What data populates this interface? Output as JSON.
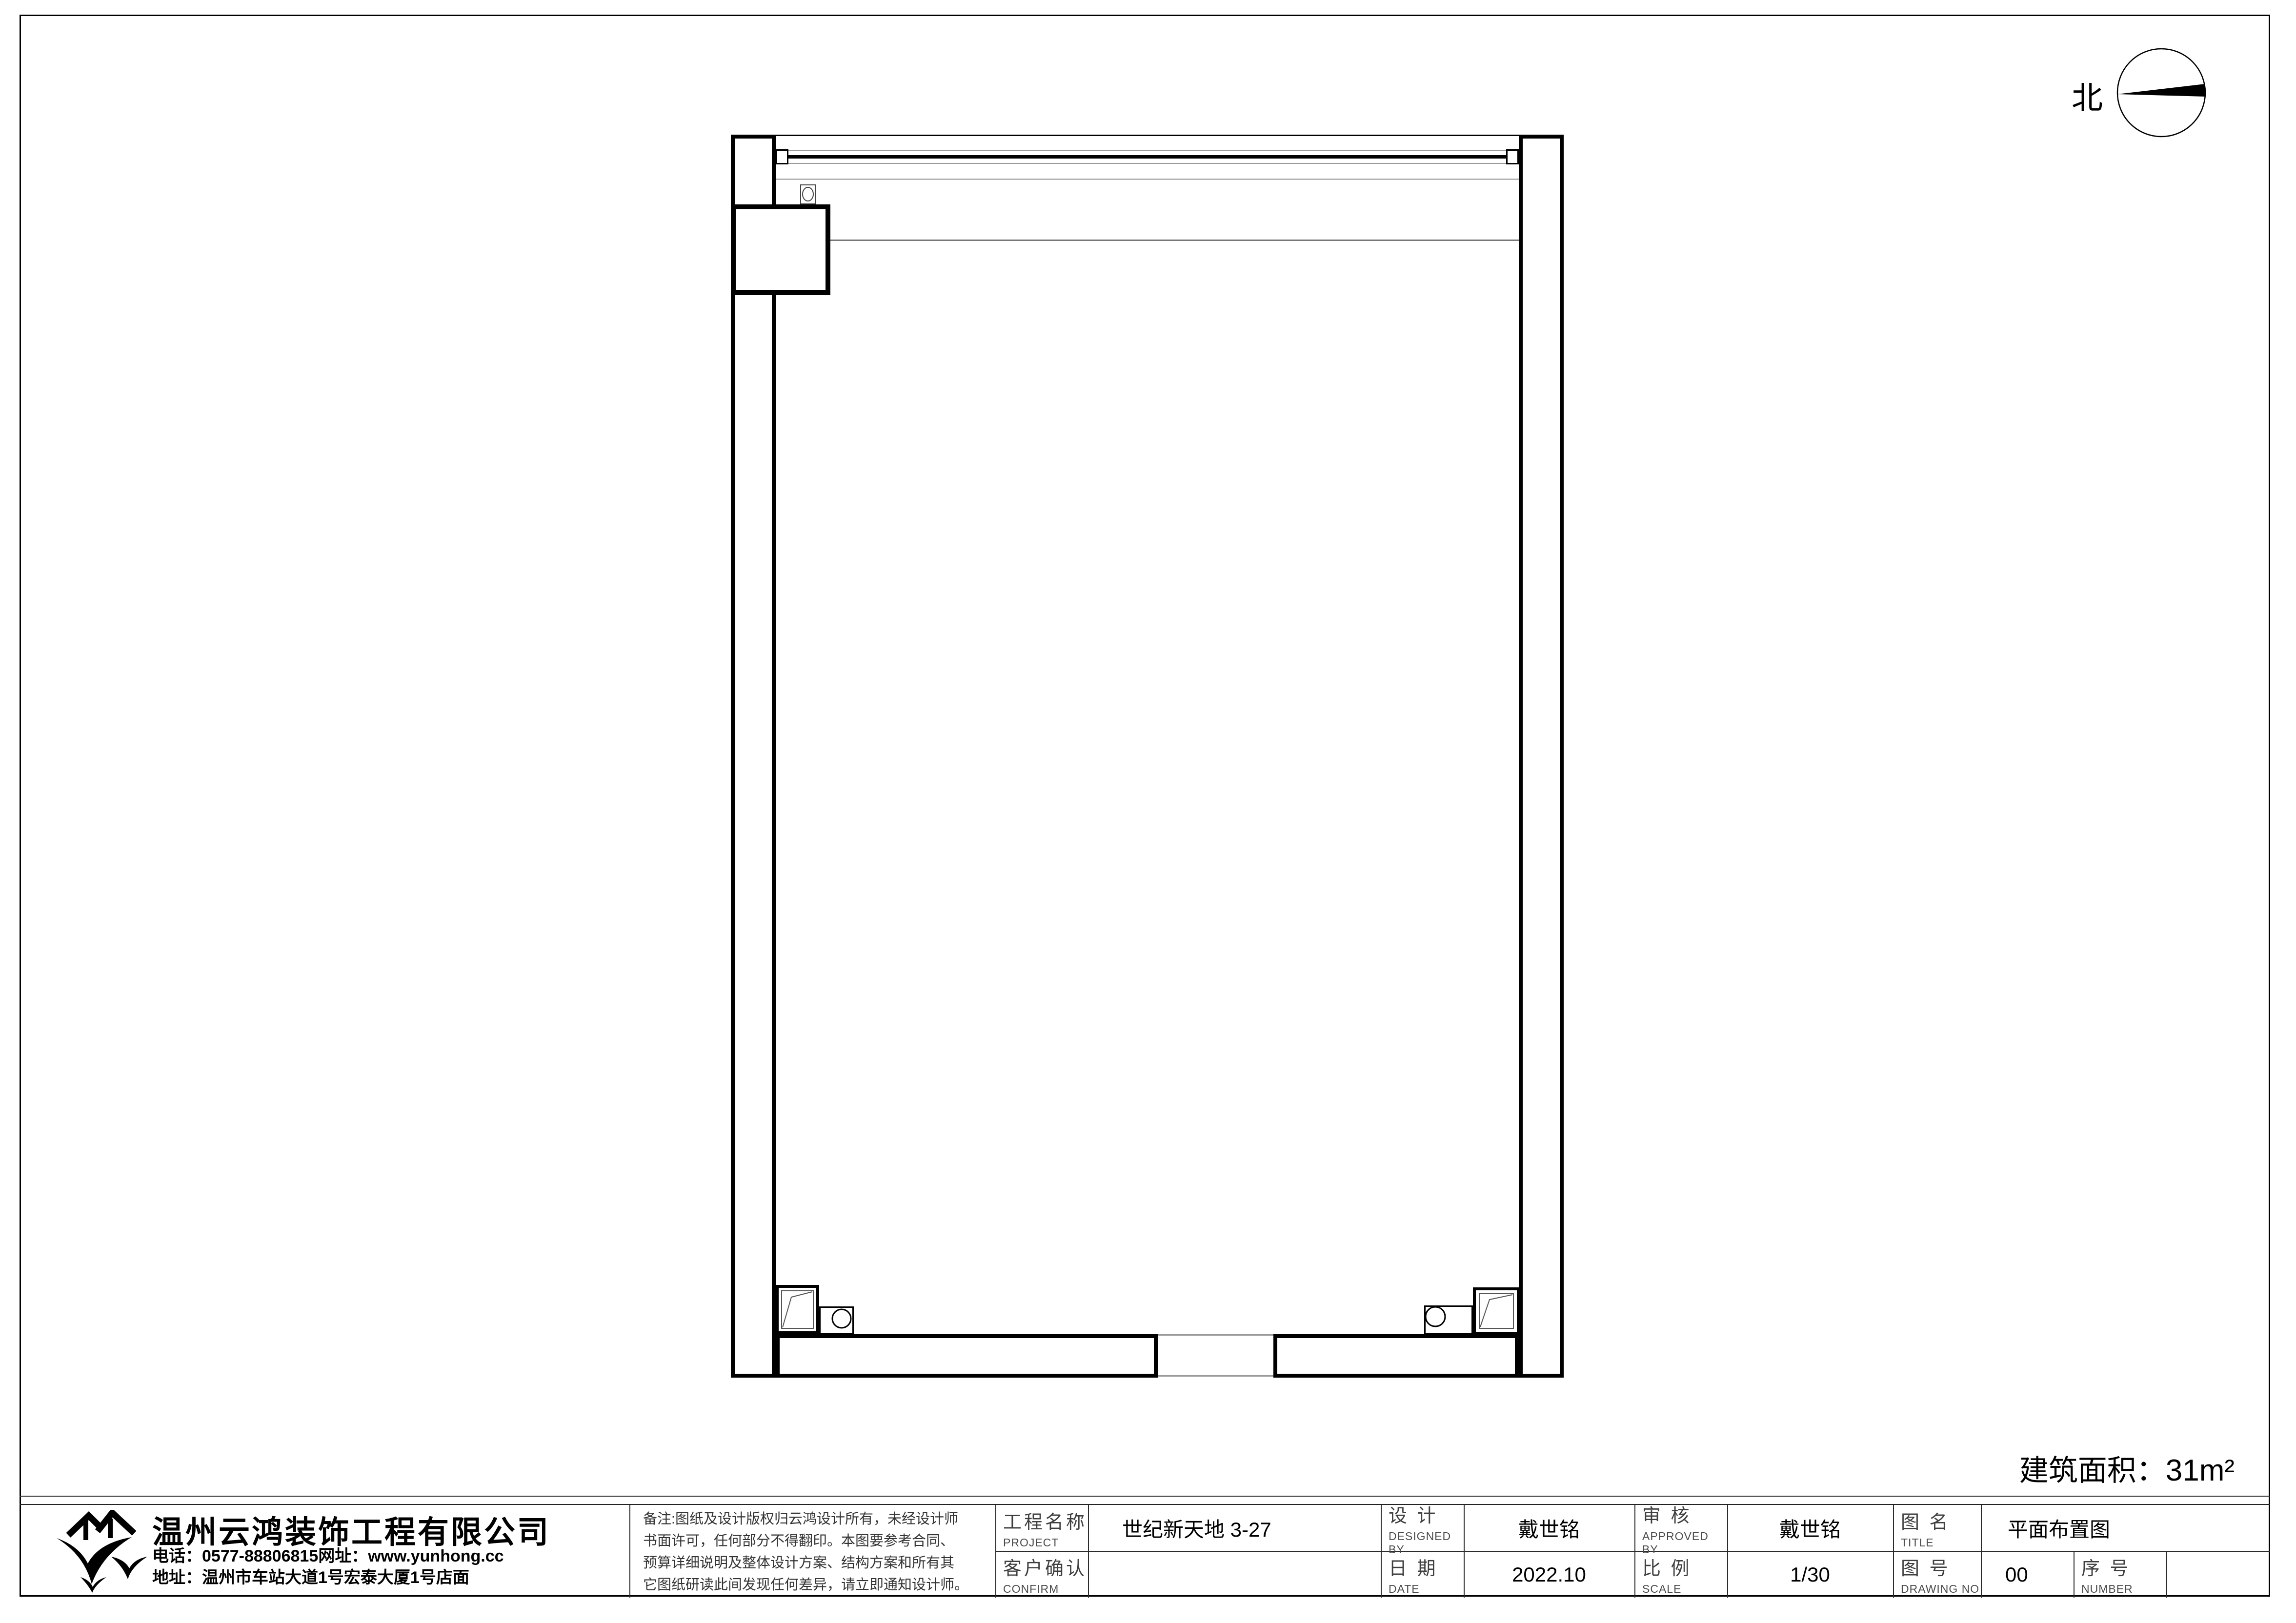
{
  "sheet": {
    "north_label": "北",
    "area_label": "建筑面积：",
    "area_value": "31m²"
  },
  "colors": {
    "ink": "#000000",
    "light_line": "#9a9a9a",
    "label_text": "#3f3f3f"
  },
  "title_block": {
    "company": {
      "name": "温州云鸿装饰工程有限公司",
      "phone": "电话：0577-88806815网址：www.yunhong.cc",
      "address": "地址：温州市车站大道1号宏泰大厦1号店面"
    },
    "notes": {
      "line1": "备注:图纸及设计版权归云鸿设计所有，未经设计师",
      "line2": "书面许可，任何部分不得翻印。本图要参考合同、",
      "line3": "预算详细说明及整体设计方案、结构方案和所有其",
      "line4": "它图纸研读此间发现任何差异，请立即通知设计师。"
    },
    "project": {
      "cn": "工程名称",
      "en": "PROJECT",
      "value": "世纪新天地 3-27"
    },
    "confirm": {
      "cn": "客户确认",
      "en": "CONFIRM",
      "value": ""
    },
    "designer": {
      "cn": "设 计",
      "en": "DESIGNED BY",
      "value": "戴世铭"
    },
    "date": {
      "cn": "日 期",
      "en": "DATE",
      "value": "2022.10"
    },
    "approver": {
      "cn": "审 核",
      "en": "APPROVED BY",
      "value": "戴世铭"
    },
    "scale": {
      "cn": "比 例",
      "en": "SCALE",
      "value": "1/30"
    },
    "drawing_title": {
      "cn": "图 名",
      "en": "TITLE",
      "value": "平面布置图"
    },
    "drawing_no": {
      "cn": "图 号",
      "en": "DRAWING NO",
      "value": "00"
    },
    "number": {
      "cn": "序 号",
      "en": "NUMBER",
      "value": ""
    }
  }
}
